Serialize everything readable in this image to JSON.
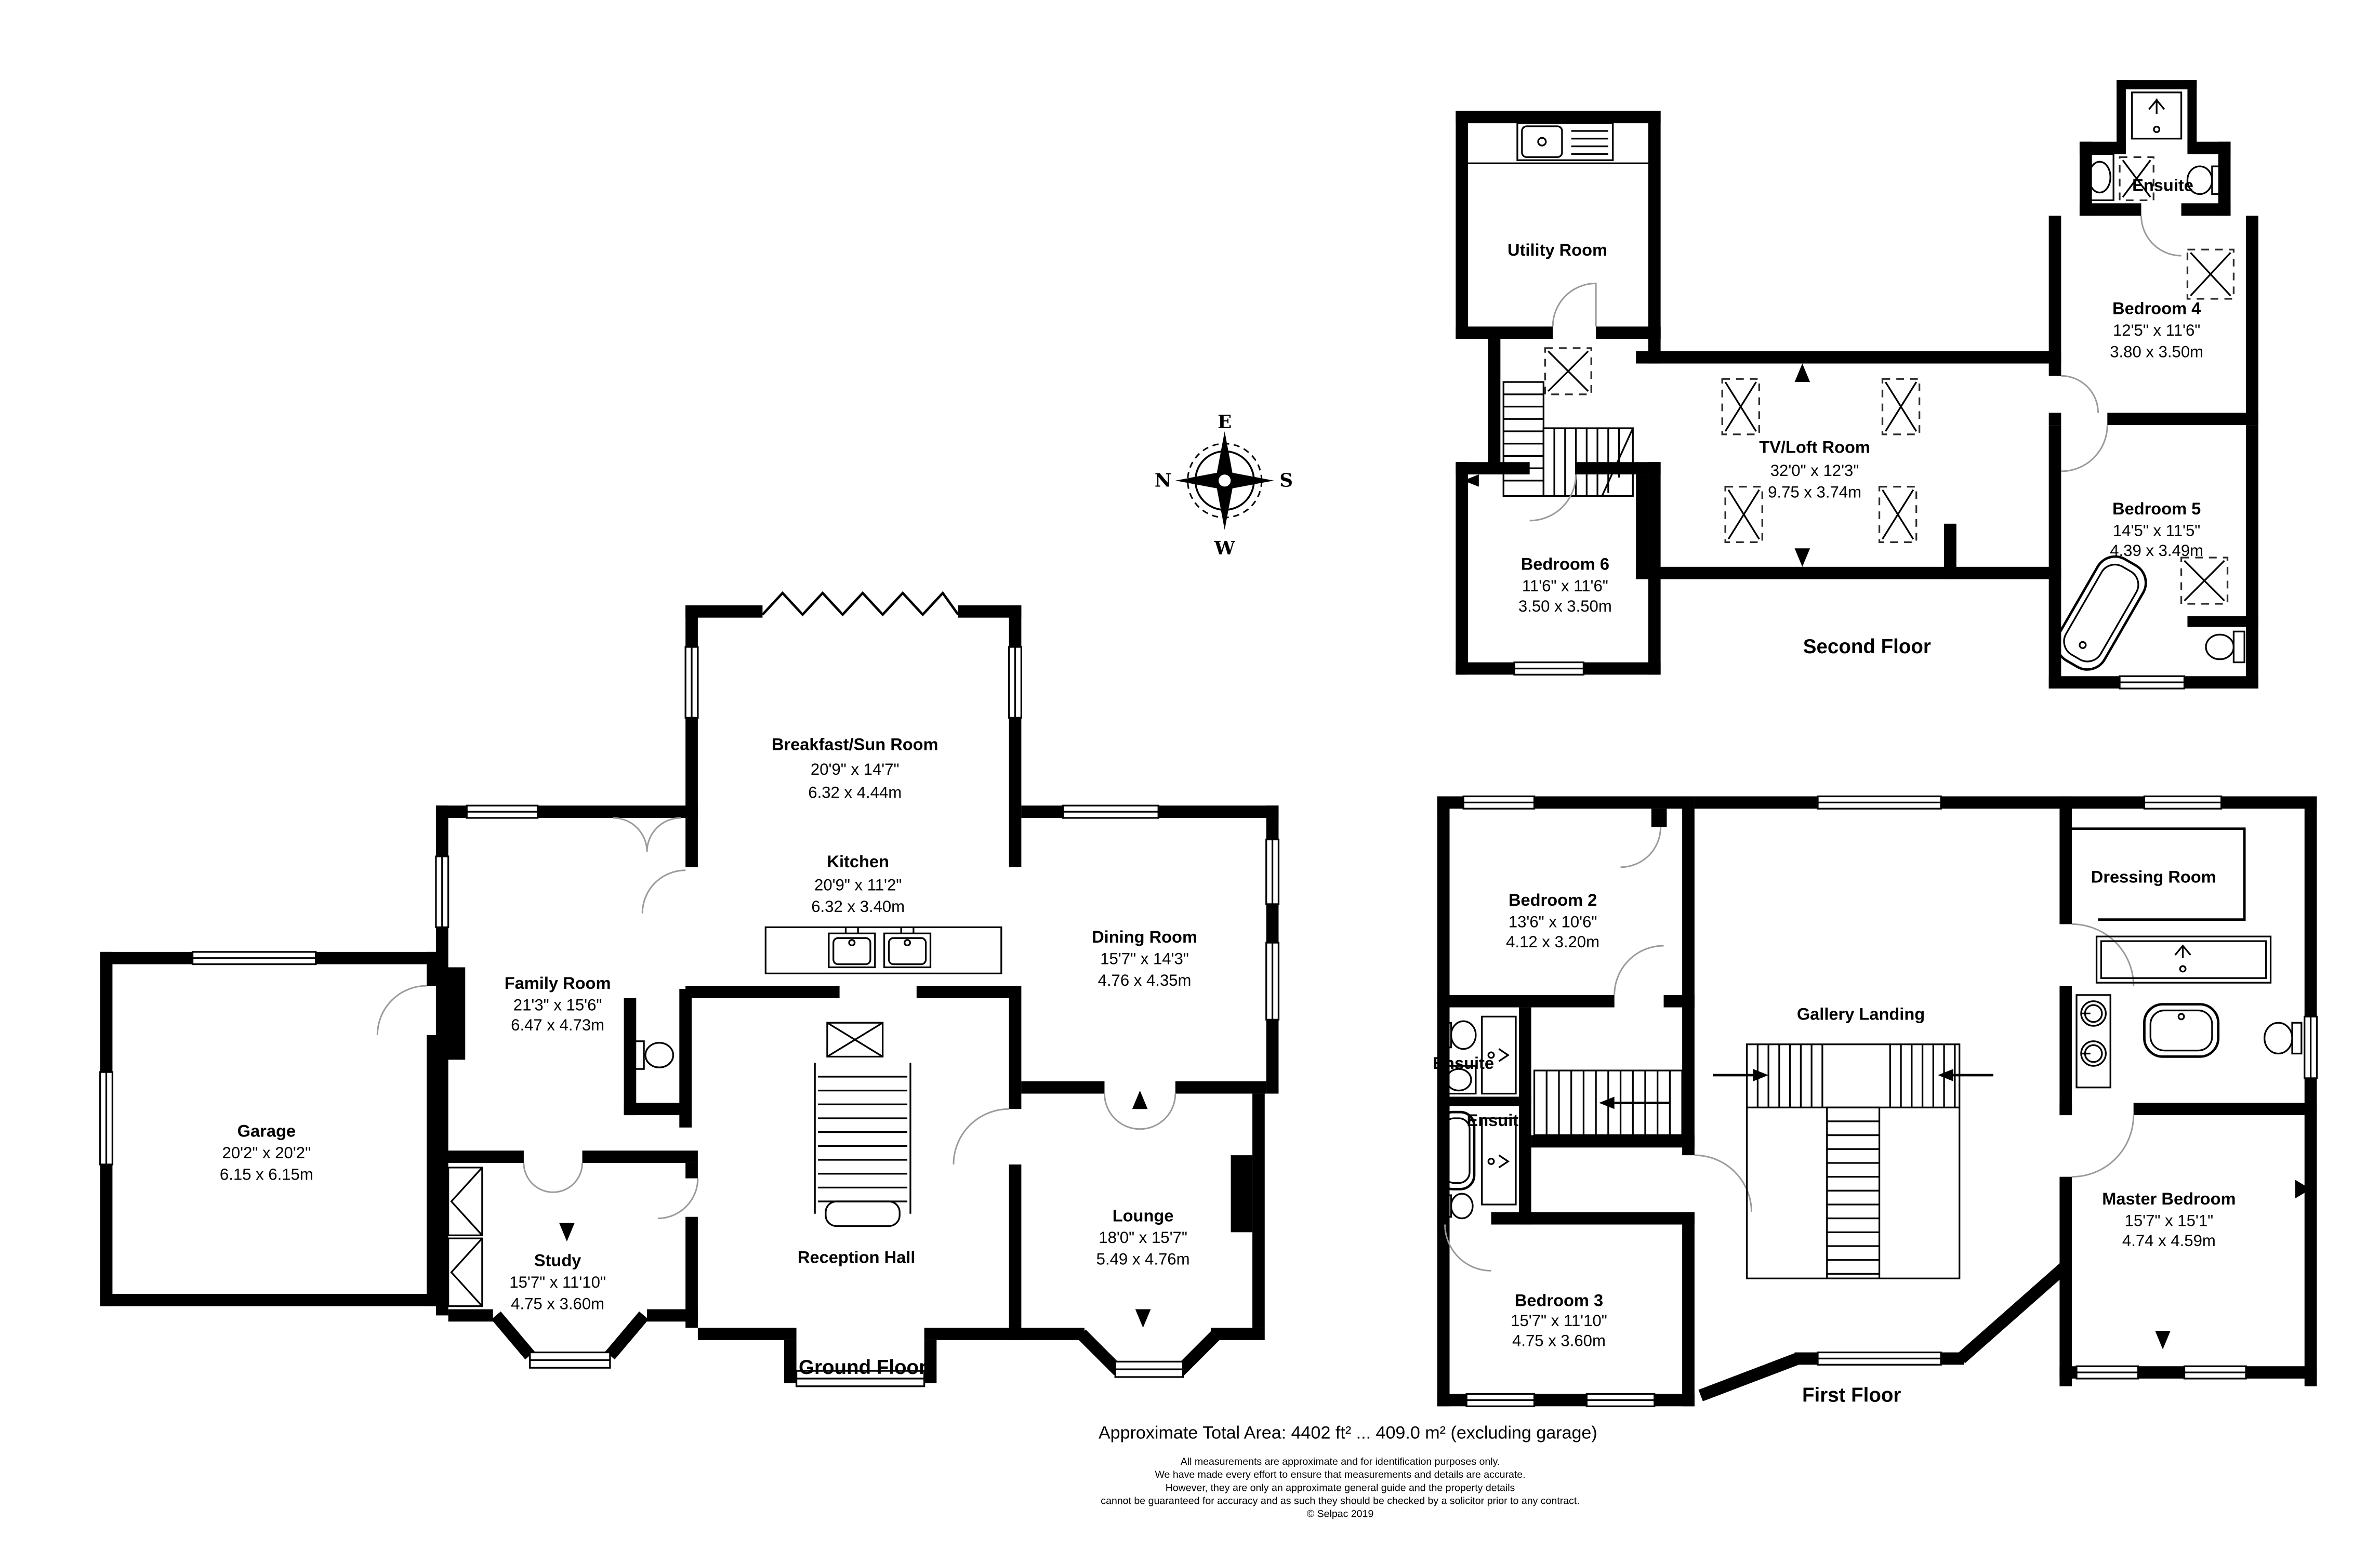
{
  "compass": {
    "top": "E",
    "left": "N",
    "right": "S",
    "bottom": "W"
  },
  "floors": [
    {
      "label": "Ground Floor",
      "rooms": [
        {
          "name": "Breakfast/Sun Room",
          "imperial": "20'9\" x 14'7\"",
          "metric": "6.32 x 4.44m"
        },
        {
          "name": "Kitchen",
          "imperial": "20'9\" x 11'2\"",
          "metric": "6.32 x 3.40m"
        },
        {
          "name": "Dining Room",
          "imperial": "15'7\" x 14'3\"",
          "metric": "4.76 x 4.35m"
        },
        {
          "name": "Family Room",
          "imperial": "21'3\" x 15'6\"",
          "metric": "6.47 x 4.73m"
        },
        {
          "name": "Garage",
          "imperial": "20'2\" x 20'2\"",
          "metric": "6.15 x 6.15m"
        },
        {
          "name": "Study",
          "imperial": "15'7\" x 11'10\"",
          "metric": "4.75 x 3.60m"
        },
        {
          "name": "Reception Hall"
        },
        {
          "name": "Lounge",
          "imperial": "18'0\" x 15'7\"",
          "metric": "5.49 x 4.76m"
        }
      ]
    },
    {
      "label": "First Floor",
      "rooms": [
        {
          "name": "Bedroom 2",
          "imperial": "13'6\" x 10'6\"",
          "metric": "4.12 x 3.20m"
        },
        {
          "name": "Ensuite"
        },
        {
          "name": "Ensuite"
        },
        {
          "name": "Gallery Landing"
        },
        {
          "name": "Dressing Room"
        },
        {
          "name": "Master Bedroom",
          "imperial": "15'7\" x 15'1\"",
          "metric": "4.74 x 4.59m"
        },
        {
          "name": "Bedroom 3",
          "imperial": "15'7\" x 11'10\"",
          "metric": "4.75 x 3.60m"
        }
      ]
    },
    {
      "label": "Second Floor",
      "rooms": [
        {
          "name": "Utility Room"
        },
        {
          "name": "TV/Loft Room",
          "imperial": "32'0\" x 12'3\"",
          "metric": "9.75 x 3.74m"
        },
        {
          "name": "Ensuite"
        },
        {
          "name": "Bedroom 4",
          "imperial": "12'5\" x 11'6\"",
          "metric": "3.80 x 3.50m"
        },
        {
          "name": "Bedroom 5",
          "imperial": "14'5\" x 11'5\"",
          "metric": "4.39 x 3.49m"
        },
        {
          "name": "Bedroom 6",
          "imperial": "11'6\" x 11'6\"",
          "metric": "3.50 x 3.50m"
        }
      ]
    }
  ],
  "footer": {
    "total_area": "Approximate Total Area: 4402 ft² ... 409.0 m² (excluding garage)",
    "disclaimer": [
      "All measurements are approximate and for identification purposes only.",
      "We have made every effort to ensure that measurements and details are accurate.",
      "However, they are only an approximate general guide and the property details",
      "cannot be guaranteed for accuracy and as such they should be checked by a solicitor prior to any contract.",
      "© Selpac 2019"
    ]
  }
}
